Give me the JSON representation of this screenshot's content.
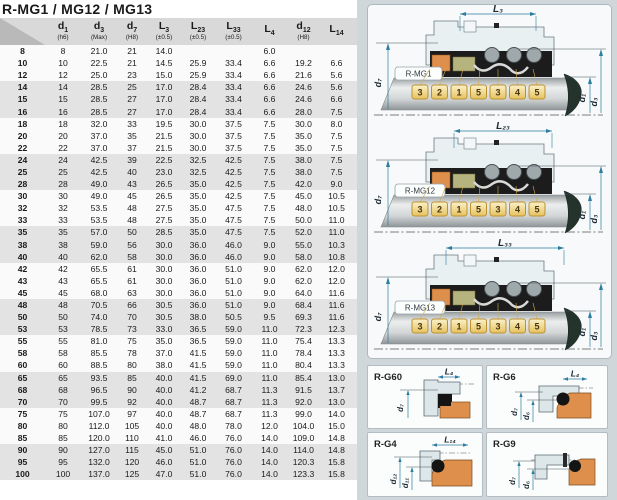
{
  "title": "R-MG1 / MG12 / MG13",
  "table": {
    "columns": [
      {
        "base": "",
        "sub": "",
        "note": ""
      },
      {
        "base": "d",
        "sub": "1",
        "note": "(h6)"
      },
      {
        "base": "d",
        "sub": "3",
        "note": "(Max)"
      },
      {
        "base": "d",
        "sub": "7",
        "note": "(H8)"
      },
      {
        "base": "L",
        "sub": "3",
        "note": "(±0.5)"
      },
      {
        "base": "L",
        "sub": "23",
        "note": "(±0.5)"
      },
      {
        "base": "L",
        "sub": "33",
        "note": "(±0.5)"
      },
      {
        "base": "L",
        "sub": "4",
        "note": ""
      },
      {
        "base": "d",
        "sub": "12",
        "note": "(H8)"
      },
      {
        "base": "L",
        "sub": "14",
        "note": ""
      }
    ],
    "rows": [
      [
        "8",
        "8",
        "21.0",
        "21",
        "14.0",
        "",
        "",
        "6.0",
        "",
        ""
      ],
      [
        "10",
        "10",
        "22.5",
        "21",
        "14.5",
        "25.9",
        "33.4",
        "6.6",
        "19.2",
        "6.6"
      ],
      [
        "12",
        "12",
        "25.0",
        "23",
        "15.0",
        "25.9",
        "33.4",
        "6.6",
        "21.6",
        "5.6"
      ],
      [
        "14",
        "14",
        "28.5",
        "25",
        "17.0",
        "28.4",
        "33.4",
        "6.6",
        "24.6",
        "5.6"
      ],
      [
        "15",
        "15",
        "28.5",
        "27",
        "17.0",
        "28.4",
        "33.4",
        "6.6",
        "24.6",
        "6.6"
      ],
      [
        "16",
        "16",
        "28.5",
        "27",
        "17.0",
        "28.4",
        "33.4",
        "6.6",
        "28.0",
        "7.5"
      ],
      [
        "18",
        "18",
        "32.0",
        "33",
        "19.5",
        "30.0",
        "37.5",
        "7.5",
        "30.0",
        "8.0"
      ],
      [
        "20",
        "20",
        "37.0",
        "35",
        "21.5",
        "30.0",
        "37.5",
        "7.5",
        "35.0",
        "7.5"
      ],
      [
        "22",
        "22",
        "37.0",
        "37",
        "21.5",
        "30.0",
        "37.5",
        "7.5",
        "35.0",
        "7.5"
      ],
      [
        "24",
        "24",
        "42.5",
        "39",
        "22.5",
        "32.5",
        "42.5",
        "7.5",
        "38.0",
        "7.5"
      ],
      [
        "25",
        "25",
        "42.5",
        "40",
        "23.0",
        "32.5",
        "42.5",
        "7.5",
        "38.0",
        "7.5"
      ],
      [
        "28",
        "28",
        "49.0",
        "43",
        "26.5",
        "35.0",
        "42.5",
        "7.5",
        "42.0",
        "9.0"
      ],
      [
        "30",
        "30",
        "49.0",
        "45",
        "26.5",
        "35.0",
        "42.5",
        "7.5",
        "45.0",
        "10.5"
      ],
      [
        "32",
        "32",
        "53.5",
        "48",
        "27.5",
        "35.0",
        "47.5",
        "7.5",
        "48.0",
        "10.5"
      ],
      [
        "33",
        "33",
        "53.5",
        "48",
        "27.5",
        "35.0",
        "47.5",
        "7.5",
        "50.0",
        "11.0"
      ],
      [
        "35",
        "35",
        "57.0",
        "50",
        "28.5",
        "35.0",
        "47.5",
        "7.5",
        "52.0",
        "11.0"
      ],
      [
        "38",
        "38",
        "59.0",
        "56",
        "30.0",
        "36.0",
        "46.0",
        "9.0",
        "55.0",
        "10.3"
      ],
      [
        "40",
        "40",
        "62.0",
        "58",
        "30.0",
        "36.0",
        "46.0",
        "9.0",
        "58.0",
        "10.8"
      ],
      [
        "42",
        "42",
        "65.5",
        "61",
        "30.0",
        "36.0",
        "51.0",
        "9.0",
        "62.0",
        "12.0"
      ],
      [
        "43",
        "43",
        "65.5",
        "61",
        "30.0",
        "36.0",
        "51.0",
        "9.0",
        "62.0",
        "12.0"
      ],
      [
        "45",
        "45",
        "68.0",
        "63",
        "30.0",
        "36.0",
        "51.0",
        "9.0",
        "64.0",
        "11.6"
      ],
      [
        "48",
        "48",
        "70.5",
        "66",
        "30.5",
        "36.0",
        "51.0",
        "9.0",
        "68.4",
        "11.6"
      ],
      [
        "50",
        "50",
        "74.0",
        "70",
        "30.5",
        "38.0",
        "50.5",
        "9.5",
        "69.3",
        "11.6"
      ],
      [
        "53",
        "53",
        "78.5",
        "73",
        "33.0",
        "36.5",
        "59.0",
        "11.0",
        "72.3",
        "12.3"
      ],
      [
        "55",
        "55",
        "81.0",
        "75",
        "35.0",
        "36.5",
        "59.0",
        "11.0",
        "75.4",
        "13.3"
      ],
      [
        "58",
        "58",
        "85.5",
        "78",
        "37.0",
        "41.5",
        "59.0",
        "11.0",
        "78.4",
        "13.3"
      ],
      [
        "60",
        "60",
        "88.5",
        "80",
        "38.0",
        "41.5",
        "59.0",
        "11.0",
        "80.4",
        "13.3"
      ],
      [
        "65",
        "65",
        "93.5",
        "85",
        "40.0",
        "41.5",
        "69.0",
        "11.0",
        "85.4",
        "13.0"
      ],
      [
        "68",
        "68",
        "96.5",
        "90",
        "40.0",
        "41.2",
        "68.7",
        "11.3",
        "91.5",
        "13.7"
      ],
      [
        "70",
        "70",
        "99.5",
        "92",
        "40.0",
        "48.7",
        "68.7",
        "11.3",
        "92.0",
        "13.0"
      ],
      [
        "75",
        "75",
        "107.0",
        "97",
        "40.0",
        "48.7",
        "68.7",
        "11.3",
        "99.0",
        "14.0"
      ],
      [
        "80",
        "80",
        "112.0",
        "105",
        "40.0",
        "48.0",
        "78.0",
        "12.0",
        "104.0",
        "15.0"
      ],
      [
        "85",
        "85",
        "120.0",
        "110",
        "41.0",
        "46.0",
        "76.0",
        "14.0",
        "109.0",
        "14.8"
      ],
      [
        "90",
        "90",
        "127.0",
        "115",
        "45.0",
        "51.0",
        "76.0",
        "14.0",
        "114.0",
        "14.8"
      ],
      [
        "95",
        "95",
        "132.0",
        "120",
        "46.0",
        "51.0",
        "76.0",
        "14.0",
        "120.3",
        "15.8"
      ],
      [
        "100",
        "100",
        "137.0",
        "125",
        "47.0",
        "51.0",
        "76.0",
        "14.0",
        "123.3",
        "15.8"
      ]
    ]
  },
  "seals": [
    {
      "tag": "R-MG1",
      "top_dim": "L₃",
      "left_dim": "d₇",
      "dim_d1": "d₁",
      "dim_d3": "d₃",
      "callouts": [
        "3",
        "2",
        "1",
        "5",
        "3",
        "4",
        "5"
      ]
    },
    {
      "tag": "R-MG12",
      "top_dim": "L₂₃",
      "left_dim": "d₇",
      "dim_d1": "d₁",
      "dim_d3": "d₃",
      "callouts": [
        "3",
        "2",
        "1",
        "5",
        "3",
        "4",
        "5"
      ]
    },
    {
      "tag": "R-MG13",
      "top_dim": "L₃₃",
      "left_dim": "d₇",
      "dim_d1": "d₁",
      "dim_d3": "d₃",
      "callouts": [
        "3",
        "2",
        "1",
        "5",
        "3",
        "4",
        "5"
      ]
    }
  ],
  "detail_panels": [
    {
      "label": "R-G60",
      "top_dim": "L₄",
      "dim_a": "d₇",
      "dim_b": ""
    },
    {
      "label": "R-G6",
      "top_dim": "L₄",
      "dim_a": "d₇",
      "dim_b": "d₆"
    },
    {
      "label": "R-G4",
      "top_dim": "L₁₄",
      "dim_a": "d₁₂",
      "dim_b": "d₁₁"
    },
    {
      "label": "R-G9",
      "top_dim": "",
      "dim_a": "d₇",
      "dim_b": "d₆"
    }
  ],
  "colors": {
    "accent_dim": "#2c7da0",
    "callout_gold": "#e9c96a",
    "part_orange": "#de8f4c",
    "part_olive": "#b5b47f",
    "band_gray": "#e3e3e3",
    "right_bg": "#cfd7db",
    "panel_bg": "#f7f9fa"
  }
}
